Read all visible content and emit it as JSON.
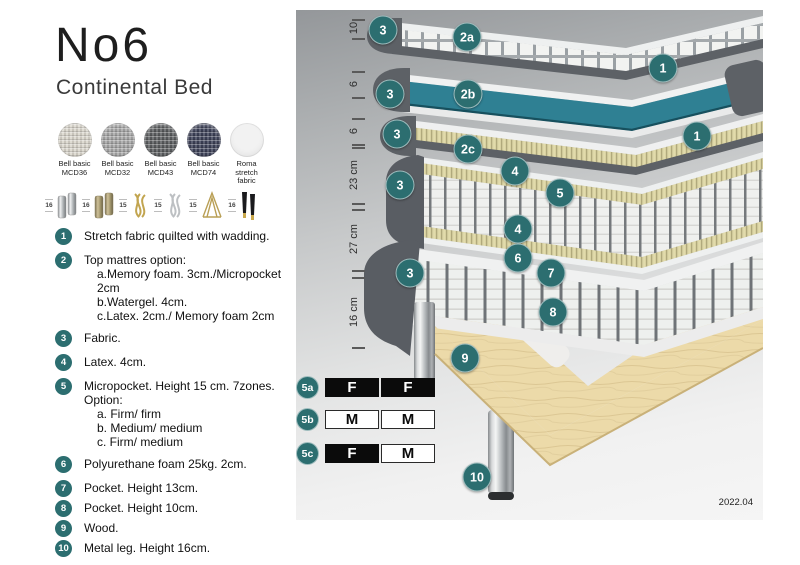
{
  "title": "No6",
  "subtitle": "Continental Bed",
  "fabric_swatches": [
    {
      "line1": "Bell basic",
      "line2": "MCD36",
      "color": "#d9d5cb"
    },
    {
      "line1": "Bell basic",
      "line2": "MCD32",
      "color": "#a6a6a6"
    },
    {
      "line1": "Bell basic",
      "line2": "MCD43",
      "color": "#5b5d5f"
    },
    {
      "line1": "Bell basic",
      "line2": "MCD74",
      "color": "#3d4158"
    },
    {
      "line1": "Roma",
      "line2": "stretch fabric",
      "color": "#f2f2f2"
    }
  ],
  "leg_options": [
    {
      "height": "16",
      "name": "cylinder-chrome"
    },
    {
      "height": "16",
      "name": "cylinder-brass"
    },
    {
      "height": "15",
      "name": "twisted-gold"
    },
    {
      "height": "15",
      "name": "twisted-chrome"
    },
    {
      "height": "15",
      "name": "hairpin-gold"
    },
    {
      "height": "16",
      "name": "tapered-black-gold"
    }
  ],
  "legend": [
    {
      "num": "1",
      "text": "Stretch fabric quilted with wadding."
    },
    {
      "num": "2",
      "text": "Top mattres option:",
      "sub": [
        "a.Memory foam. 3cm./Micropocket 2cm",
        "b.Watergel. 4cm.",
        "c.Latex. 2cm./ Memory foam 2cm"
      ]
    },
    {
      "num": "3",
      "text": "Fabric."
    },
    {
      "num": "4",
      "text": "Latex. 4cm."
    },
    {
      "num": "5",
      "text": "Micropocket. Height 15 cm. 7zones. Option:",
      "sub": [
        "a. Firm/ firm",
        "b. Medium/ medium",
        "c. Firm/ medium"
      ]
    },
    {
      "num": "6",
      "text": "Polyurethane foam 25kg. 2cm."
    },
    {
      "num": "7",
      "text": "Pocket. Height 13cm."
    },
    {
      "num": "8",
      "text": "Pocket. Height 10cm."
    },
    {
      "num": "9",
      "text": "Wood."
    },
    {
      "num": "10",
      "text": "Metal leg. Height 16cm."
    }
  ],
  "diagram": {
    "dimension_labels": [
      "10",
      "6",
      "6",
      "23 cm",
      "27 cm",
      "16 cm"
    ],
    "badges": [
      "3",
      "2a",
      "1",
      "3",
      "2b",
      "1",
      "3",
      "2c",
      "4",
      "3",
      "5",
      "4",
      "6",
      "3",
      "7",
      "8",
      "9",
      "10"
    ],
    "firmness_rows": [
      {
        "label": "5a",
        "cells": [
          {
            "text": "F",
            "variant": "dark"
          },
          {
            "text": "F",
            "variant": "dark"
          }
        ]
      },
      {
        "label": "5b",
        "cells": [
          {
            "text": "M",
            "variant": "light"
          },
          {
            "text": "M",
            "variant": "light"
          }
        ]
      },
      {
        "label": "5c",
        "cells": [
          {
            "text": "F",
            "variant": "dark"
          },
          {
            "text": "M",
            "variant": "light"
          }
        ]
      }
    ],
    "version": "2022.04"
  },
  "colors": {
    "accent_teal": "#2c6e70",
    "watergel_teal": "#2f8093",
    "foam_yellow": "#d8d1a1",
    "shell_gray": "#5d6166",
    "wood": "#ecdaa9",
    "firm_dark": "#0b0b0b",
    "firm_light": "#ffffff"
  }
}
